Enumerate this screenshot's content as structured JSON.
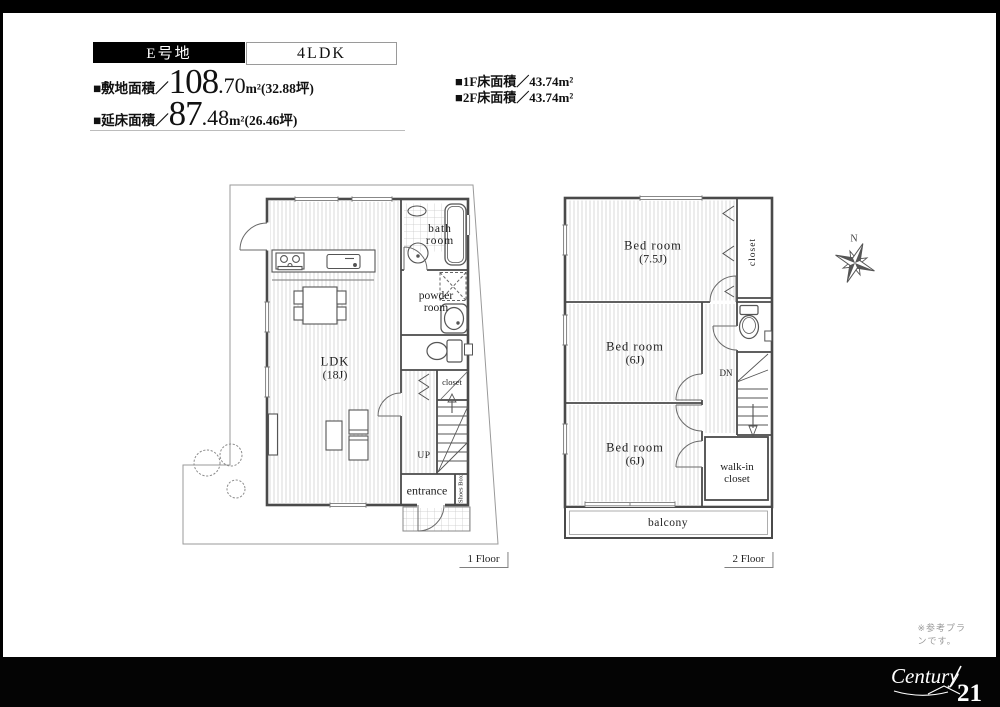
{
  "colors": {
    "frame": "#000000",
    "badge_bg": "#000000",
    "wall": "#4a4a4a",
    "site_boundary": "#9a9a9a",
    "hatch": "#d9d9d9",
    "note_text": "#999999"
  },
  "header": {
    "lot_label": "E号地",
    "plan_type": "4LDK",
    "site_area": {
      "label": "■敷地面積／",
      "big": "108",
      "small": ".70",
      "suffix": "m²(32.88坪)"
    },
    "total_area": {
      "label": "■延床面積／",
      "big": "87",
      "small": ".48",
      "suffix": "m²(26.46坪)"
    },
    "floor1_area": "■1F床面積／43.74m²",
    "floor2_area": "■2F床面積／43.74m²"
  },
  "floor1": {
    "caption": "1 Floor",
    "labels": {
      "ldk": "LDK",
      "ldk_size": "(18J)",
      "bath_line1": "bath",
      "bath_line2": "room",
      "powder_line1": "powder",
      "powder_line2": "room",
      "closet": "closet",
      "up": "UP",
      "entrance": "entrance",
      "shoes_box": "Shoes Box"
    }
  },
  "floor2": {
    "caption": "2 Floor",
    "labels": {
      "bed1": "Bed room",
      "bed1_size": "(7.5J)",
      "bed2": "Bed room",
      "bed2_size": "(6J)",
      "bed3": "Bed room",
      "bed3_size": "(6J)",
      "closet": "closet",
      "dn": "DN",
      "walkin_line1": "walk-in",
      "walkin_line2": "closet",
      "balcony": "balcony"
    }
  },
  "compass": {
    "north": "N"
  },
  "footer": {
    "note": "※参考プランです。",
    "brand_script": "Century",
    "brand_number": "21"
  }
}
